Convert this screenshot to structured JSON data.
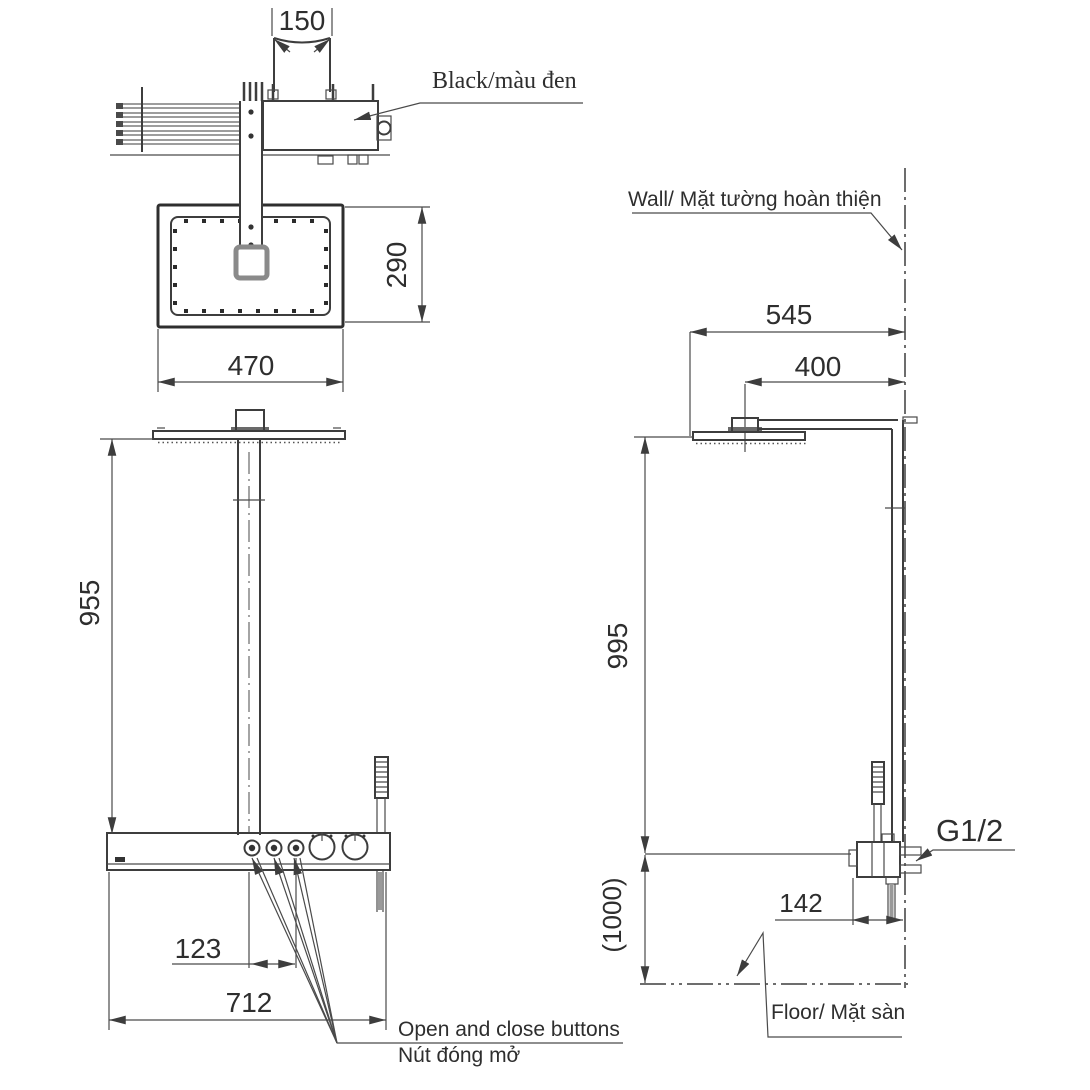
{
  "drawing": {
    "kind": "shower-column-installation-technical-drawing",
    "labels": {
      "black": "Black/màu đen",
      "wall": "Wall/ Mặt tường hoàn thiện",
      "floor": "Floor/ Mặt sàn",
      "open_close_en": "Open and close buttons",
      "open_close_vi": "Nút đóng mở",
      "thread": "G1/2"
    },
    "dimensions": {
      "d150": "150",
      "d290": "290",
      "d470": "470",
      "d955": "955",
      "d123": "123",
      "d712": "712",
      "d545": "545",
      "d400": "400",
      "d995": "995",
      "d1000": "(1000)",
      "d142": "142"
    },
    "colors": {
      "line": "#3d3d3d",
      "pipe_gray": "#7d7d7d",
      "connector_gray": "#8a8a8a",
      "text": "#2e2e2e",
      "background": "#ffffff"
    }
  }
}
